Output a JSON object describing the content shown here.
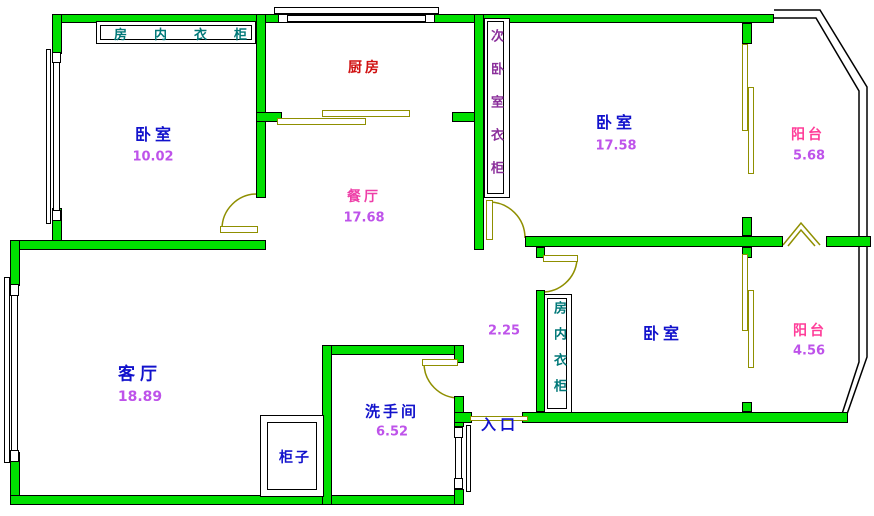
{
  "canvas": {
    "width": 874,
    "height": 516
  },
  "colors": {
    "wall_fill": "#00DF00",
    "wall_outline": "#000000",
    "door_color": "#8F8F00",
    "room_label_color": "#1212CC",
    "area_value_color": "#BE53EA",
    "kitchen_label_color": "#D01111",
    "dining_label_color": "#EE3FA8",
    "balcony_label_color": "#FF3D99",
    "wardrobe_label_color": "#007878",
    "side_wardrobe_label_color": "#8B2F9B"
  },
  "rooms": {
    "bedroom_top_left": {
      "name": "卧室",
      "area": "10.02"
    },
    "kitchen": {
      "name": "厨房"
    },
    "dining": {
      "name": "餐厅",
      "area": "17.68"
    },
    "bedroom_top_right": {
      "name": "卧室",
      "area": "17.58"
    },
    "balcony_top": {
      "name": "阳台",
      "area": "5.68"
    },
    "hallway": {
      "area": "2.25"
    },
    "bedroom_bottom_right": {
      "name": "卧室"
    },
    "balcony_bottom": {
      "name": "阳台",
      "area": "4.56"
    },
    "living_room": {
      "name": "客厅",
      "area": "18.89"
    },
    "bathroom": {
      "name": "洗手间",
      "area": "6.52"
    },
    "cabinet": {
      "name": "柜子"
    },
    "entrance": {
      "name": "入口"
    }
  },
  "wardrobes": {
    "top": "房内衣柜",
    "secondary": "次卧室衣柜",
    "bottom": "房内衣柜"
  }
}
